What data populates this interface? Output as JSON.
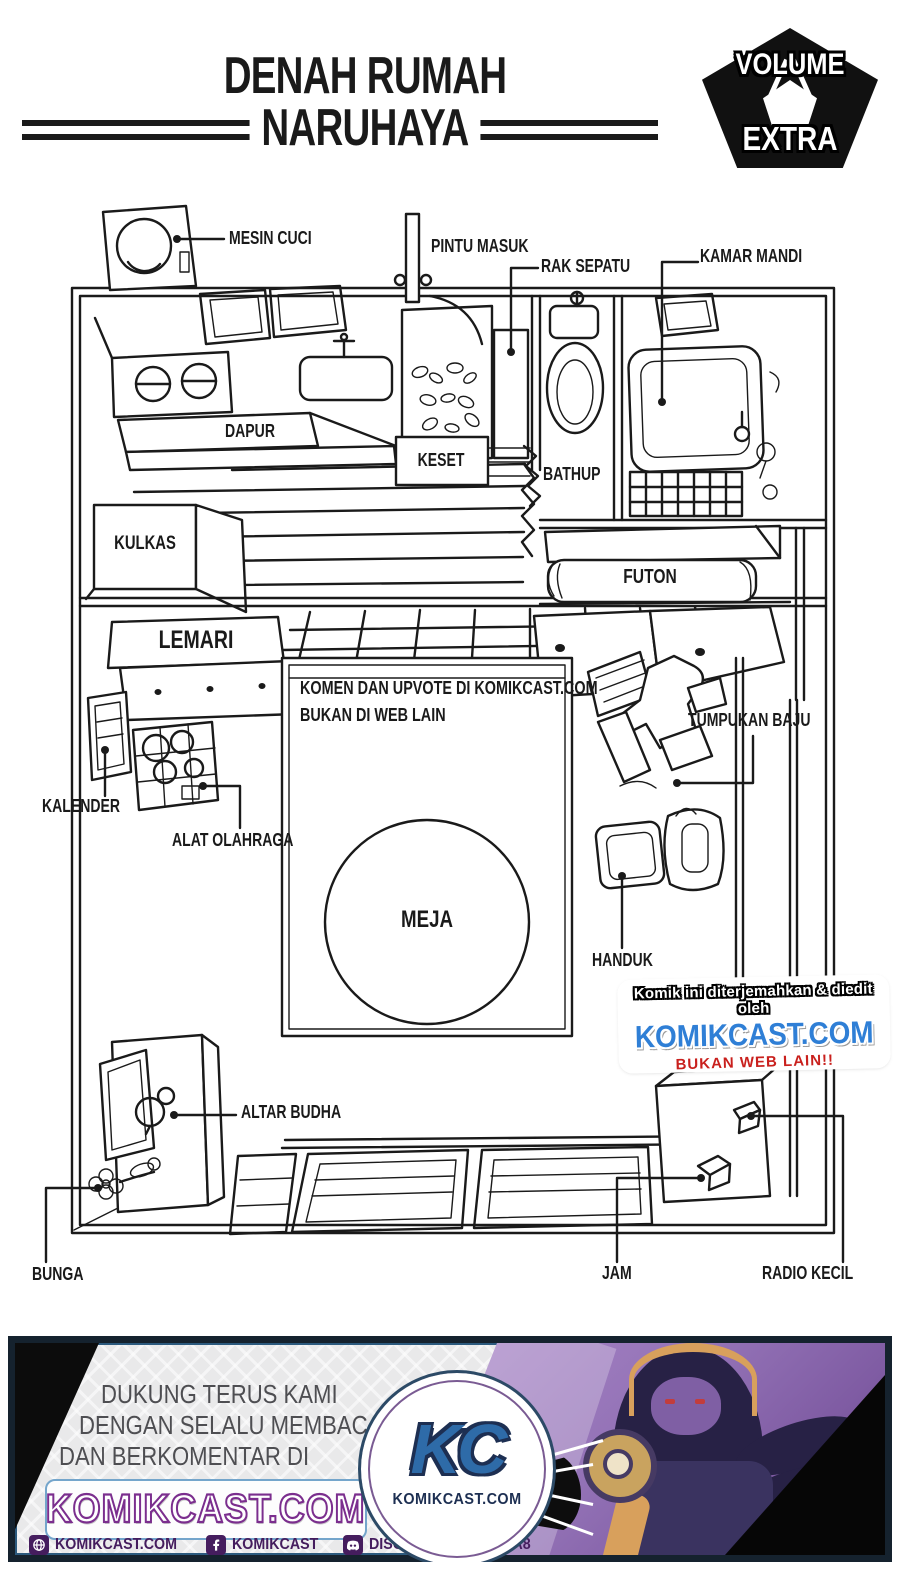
{
  "title": {
    "line1": "DENAH RUMAH",
    "line2": "NARUHAYA"
  },
  "badge": {
    "top": "VOLUME",
    "bottom": "EXTRA"
  },
  "plan_labels": {
    "mesin_cuci": "MESIN CUCI",
    "pintu_masuk": "PINTU MASUK",
    "rak_sepatu": "RAK SEPATU",
    "kamar_mandi": "KAMAR MANDI",
    "dapur": "DAPUR",
    "keset": "KESET",
    "bathup": "BATHUP",
    "kulkas": "KULKAS",
    "futon": "FUTON",
    "lemari": "LEMARI",
    "kalender": "KALENDER",
    "alat_olahraga": "ALAT OLAHRAGA",
    "tumpukan_baju": "TUMPUKAN BAJU",
    "handuk": "HANDUK",
    "meja": "MEJA",
    "altar_budha": "ALTAR BUDHA",
    "bunga": "BUNGA",
    "jam": "JAM",
    "radio_kecil": "RADIO KECIL"
  },
  "room_note": {
    "line1": "KOMEN DAN UPVOTE DI KOMIKCAST.COM",
    "line2": "BUKAN DI WEB LAIN"
  },
  "watermark": {
    "line1": "Komik ini diterjemahkan & diedit oleh",
    "site": "KOMIKCAST.COM",
    "line3": "BUKAN WEB LAIN!!"
  },
  "banner": {
    "support_line1": "DUKUNG TERUS KAMI",
    "support_line2": "DENGAN SELALU MEMBACA",
    "support_line3": "DAN BERKOMENTAR DI",
    "site": "KOMIKCAST.COM",
    "logo_text": "KC",
    "logo_caption": "KOMIKCAST.COM",
    "footer": [
      {
        "icon": "globe-icon",
        "label": "KOMIKCAST.COM"
      },
      {
        "icon": "facebook-icon",
        "label": "KOMIKCAST"
      },
      {
        "icon": "discord-icon",
        "label": "DISCORD.GG/N8XEKA8"
      }
    ]
  },
  "colors": {
    "ink": "#1a1a1a",
    "watermark_blue": "#2f7fd6",
    "watermark_red": "#c9201d",
    "banner_border": "#15222e",
    "banner_bg": "#e9e9ea",
    "banner_text": "#4e4e52",
    "brand_purple": "#7b2e8e",
    "box_border": "#74a5cb",
    "footer_text": "#451d5e",
    "kc_blue": "#2e6ba8",
    "art_light": "#ab88c9",
    "art_dark": "#6b4590"
  }
}
